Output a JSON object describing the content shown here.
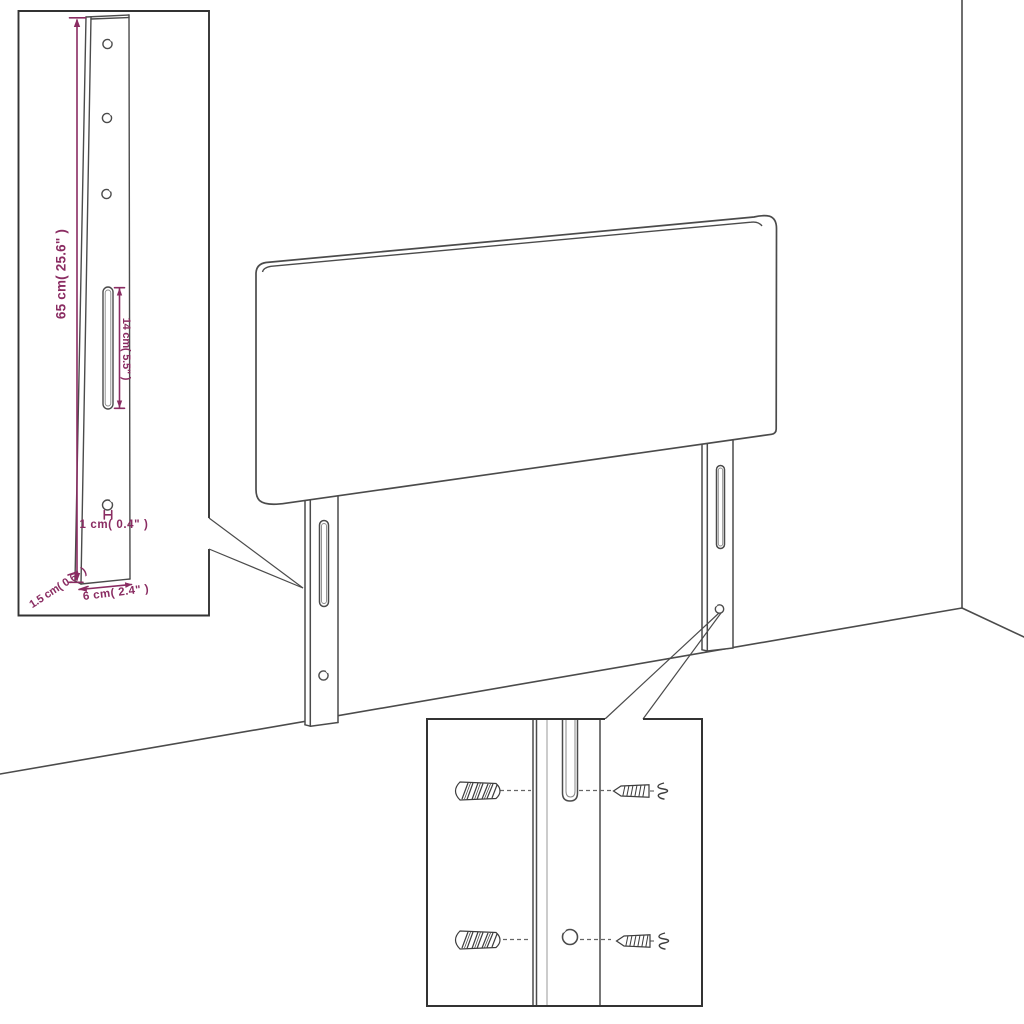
{
  "diagram": {
    "title_semantic": "headboard-dimension-diagram",
    "dimensions": {
      "bracket_height": "65 cm( 25.6\" )",
      "slot_length": "14 cm( 5.5\" )",
      "hole_diameter": "1 cm( 0.4\" )",
      "bracket_thickness": "1.5 cm( 0.6\" )",
      "bracket_width": "6 cm( 2.4\" )"
    },
    "colors": {
      "dimension_text": "#8a2c62",
      "dimension_lines": "#8a2c62",
      "drawing_lines": "#4b4b4b",
      "inset_border": "#333333",
      "background": "#ffffff"
    }
  }
}
